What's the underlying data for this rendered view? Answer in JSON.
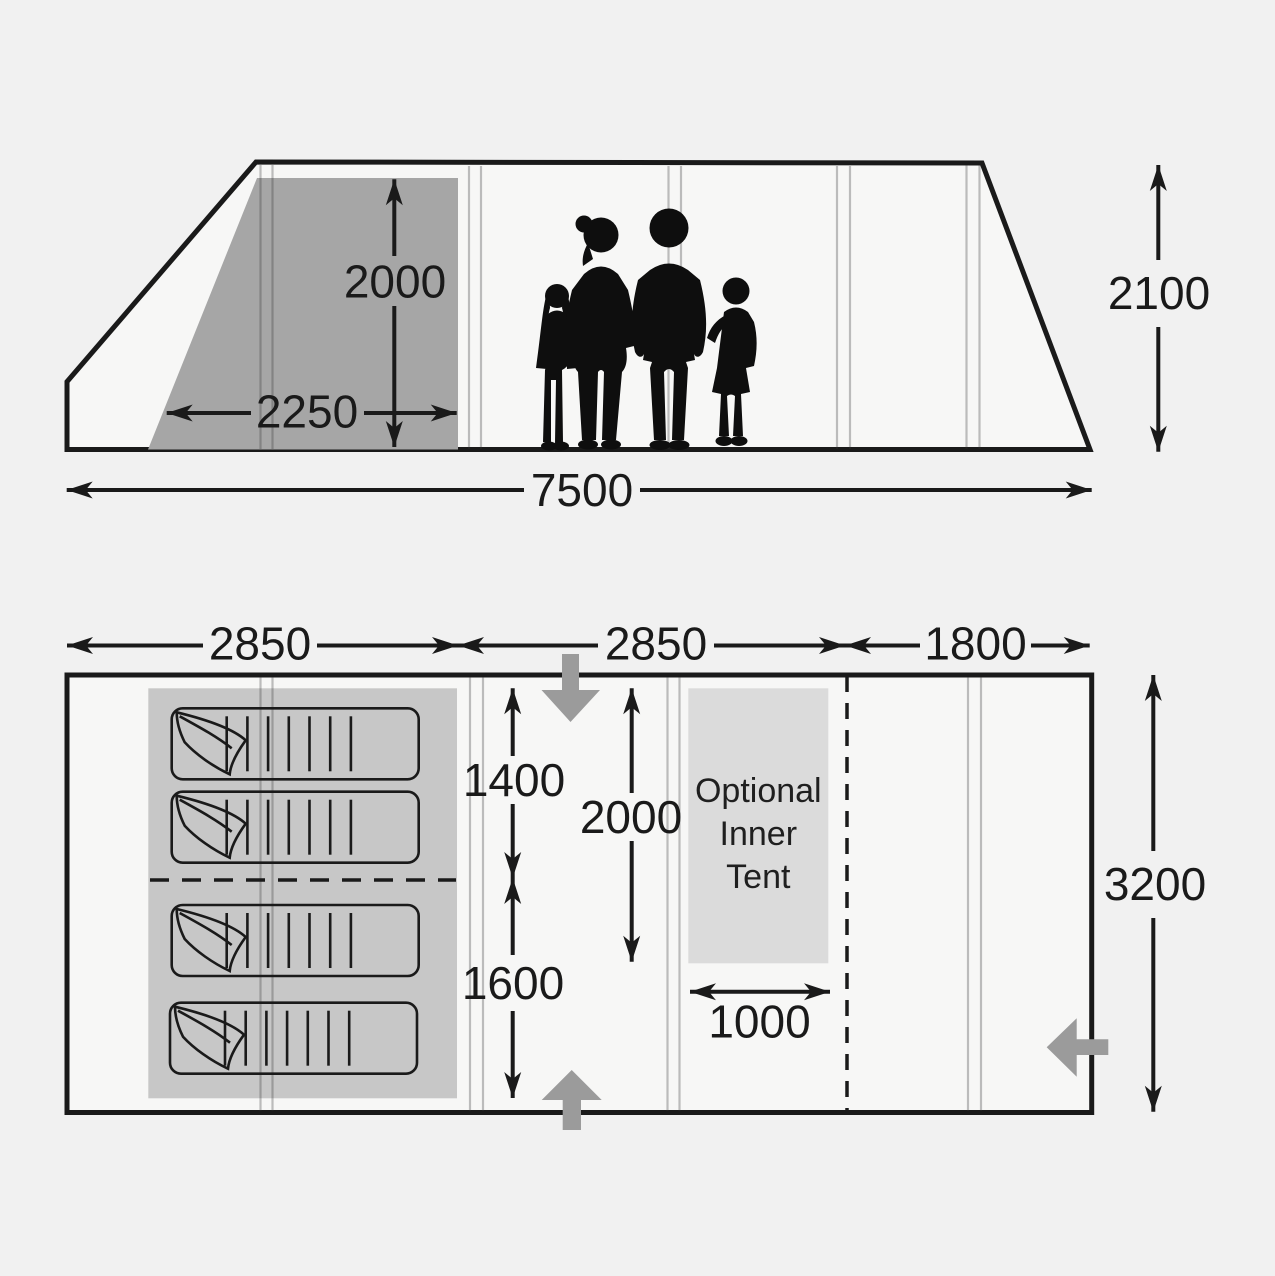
{
  "diagram_title": "Tent dimensions diagram",
  "colors": {
    "background": "#f1f1f1",
    "tent_interior": "#f7f7f6",
    "cabin_shade": "#a6a6a6",
    "sleeping_area": "#c7c7c7",
    "inner_tent": "#dbdbdb",
    "entrance_arrow": "#9b9b9b",
    "line": "#1a1a1a"
  },
  "side_view": {
    "cabin_height": "2000",
    "cabin_width": "2250",
    "total_length": "7500",
    "total_height": "2100"
  },
  "floor_plan": {
    "sections": [
      "2850",
      "2850",
      "1800"
    ],
    "bedroom_front_width": "1400",
    "bedroom_rear_width": "1600",
    "living_depth": "2000",
    "inner_tent_width": "1000",
    "total_width": "3200",
    "inner_tent_label": [
      "Optional",
      "Inner",
      "Tent"
    ]
  }
}
